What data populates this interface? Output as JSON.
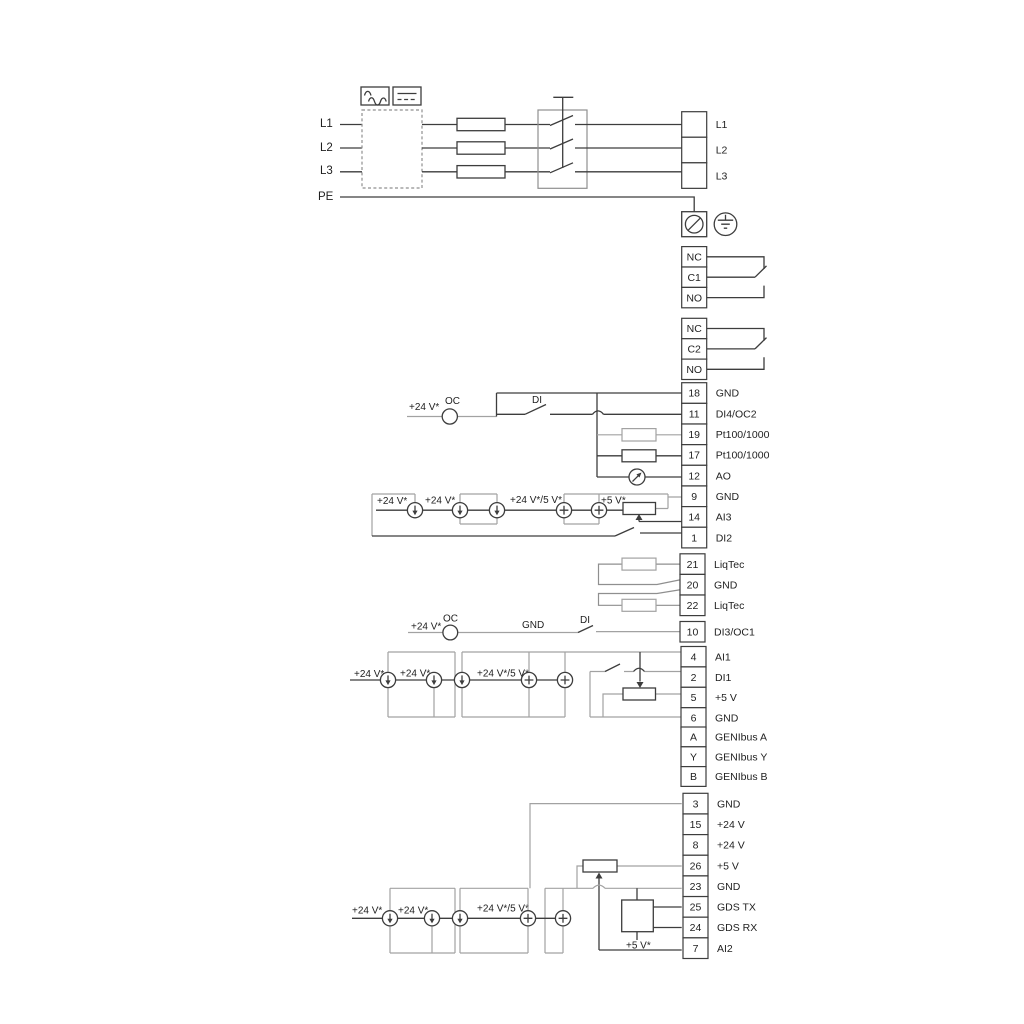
{
  "diagram_title": "frequency-converter-wiring-diagram",
  "colors": {
    "line": "#3d3d3d",
    "optional_grey": "#a2a2a2",
    "text": "#1f1f1f",
    "background": "#ffffff"
  },
  "power_input": {
    "l1": "L1",
    "l2": "L2",
    "l3": "L3",
    "pe": "PE"
  },
  "labels": {
    "v24_top": "+24 V*",
    "oc_top": "OC",
    "di_top": "DI",
    "s1_v24_a": "+24 V*",
    "s1_v24_b": "+24 V*",
    "s1_combo": "+24 V*/5 V*",
    "s1_v5": "+5 V*",
    "v24_mid": "+24 V*",
    "oc_mid": "OC",
    "gnd_mid": "GND",
    "di_mid": "DI",
    "s4_v24_a": "+24 V*",
    "s4_v24_b": "+24 V*",
    "s4_combo": "+24 V*/5 V*",
    "s5_v24_a": "+24 V*",
    "s5_v24_b": "+24 V*",
    "s5_combo": "+24 V*/5 V*",
    "s5_v5": "+5 V*"
  },
  "strips": [
    {
      "id": "mains-output",
      "rows": [
        {
          "num": "",
          "label": "L1"
        },
        {
          "num": "",
          "label": "L2"
        },
        {
          "num": "",
          "label": "L3"
        }
      ]
    },
    {
      "id": "relay-1",
      "rows": [
        {
          "num": "NC",
          "label": ""
        },
        {
          "num": "C1",
          "label": ""
        },
        {
          "num": "NO",
          "label": ""
        }
      ]
    },
    {
      "id": "relay-2",
      "rows": [
        {
          "num": "NC",
          "label": ""
        },
        {
          "num": "C2",
          "label": ""
        },
        {
          "num": "NO",
          "label": ""
        }
      ]
    },
    {
      "id": "io-strip-upper",
      "rows": [
        {
          "num": "18",
          "label": "GND"
        },
        {
          "num": "11",
          "label": "DI4/OC2"
        },
        {
          "num": "19",
          "label": "Pt100/1000"
        },
        {
          "num": "17",
          "label": "Pt100/1000"
        },
        {
          "num": "12",
          "label": "AO"
        },
        {
          "num": "9",
          "label": "GND"
        },
        {
          "num": "14",
          "label": "AI3"
        },
        {
          "num": "1",
          "label": "DI2"
        }
      ]
    },
    {
      "id": "liqtec-strip",
      "rows": [
        {
          "num": "21",
          "label": "LiqTec"
        },
        {
          "num": "20",
          "label": "GND"
        },
        {
          "num": "22",
          "label": "LiqTec"
        }
      ]
    },
    {
      "id": "di3-strip",
      "rows": [
        {
          "num": "10",
          "label": "DI3/OC1"
        }
      ]
    },
    {
      "id": "io-strip-middle",
      "rows": [
        {
          "num": "4",
          "label": "AI1"
        },
        {
          "num": "2",
          "label": "DI1"
        },
        {
          "num": "5",
          "label": "+5 V"
        },
        {
          "num": "6",
          "label": "GND"
        }
      ]
    },
    {
      "id": "genibus-strip",
      "rows": [
        {
          "num": "A",
          "label": "GENIbus A"
        },
        {
          "num": "Y",
          "label": "GENIbus Y"
        },
        {
          "num": "B",
          "label": "GENIbus B"
        }
      ]
    },
    {
      "id": "io-strip-lower",
      "rows": [
        {
          "num": "3",
          "label": "GND"
        },
        {
          "num": "15",
          "label": "+24 V"
        },
        {
          "num": "8",
          "label": "+24 V"
        },
        {
          "num": "26",
          "label": "+5 V"
        },
        {
          "num": "23",
          "label": "GND"
        },
        {
          "num": "25",
          "label": "GDS TX"
        },
        {
          "num": "24",
          "label": "GDS RX"
        },
        {
          "num": "7",
          "label": "AI2"
        }
      ]
    }
  ]
}
